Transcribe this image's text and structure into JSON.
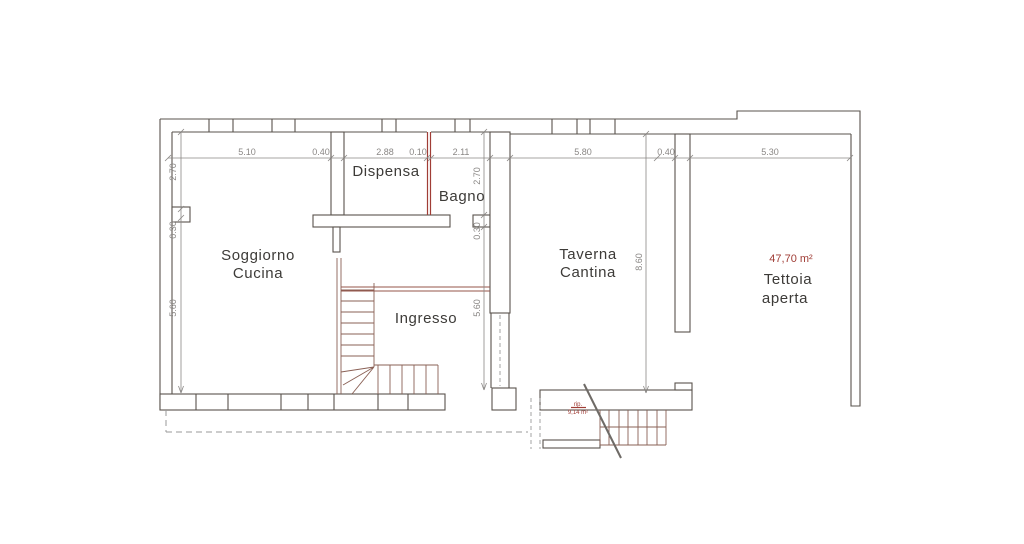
{
  "title": "Planimetria piano",
  "colors": {
    "wall": "#59534d",
    "wall_red": "#96544a",
    "stair": "#8a6055",
    "accent_red": "#a03d36",
    "dim": "#8a8785",
    "dash": "#9a9a9a",
    "text": "#3d3b38"
  },
  "rooms": {
    "dispensa": "Dispensa",
    "bagno": "Bagno",
    "soggiorno_line1": "Soggiorno",
    "soggiorno_line2": "Cucina",
    "ingresso": "Ingresso",
    "taverna_line1": "Taverna",
    "taverna_line2": "Cantina",
    "tettoia_area": "47,70 m²",
    "tettoia_line1": "Tettoia",
    "tettoia_line2": "aperta",
    "rip_line1": "rip.",
    "rip_line2": "9,14 m²"
  },
  "dimensions": {
    "top": [
      "5.10",
      "0.40",
      "2.88",
      "0.10",
      "2.11",
      "5.80",
      "0.40",
      "5.30"
    ],
    "left": [
      "2.70",
      "0.30",
      "5.60"
    ],
    "middle": [
      "2.70",
      "0.30",
      "5.60"
    ],
    "right": [
      "8.60"
    ]
  }
}
